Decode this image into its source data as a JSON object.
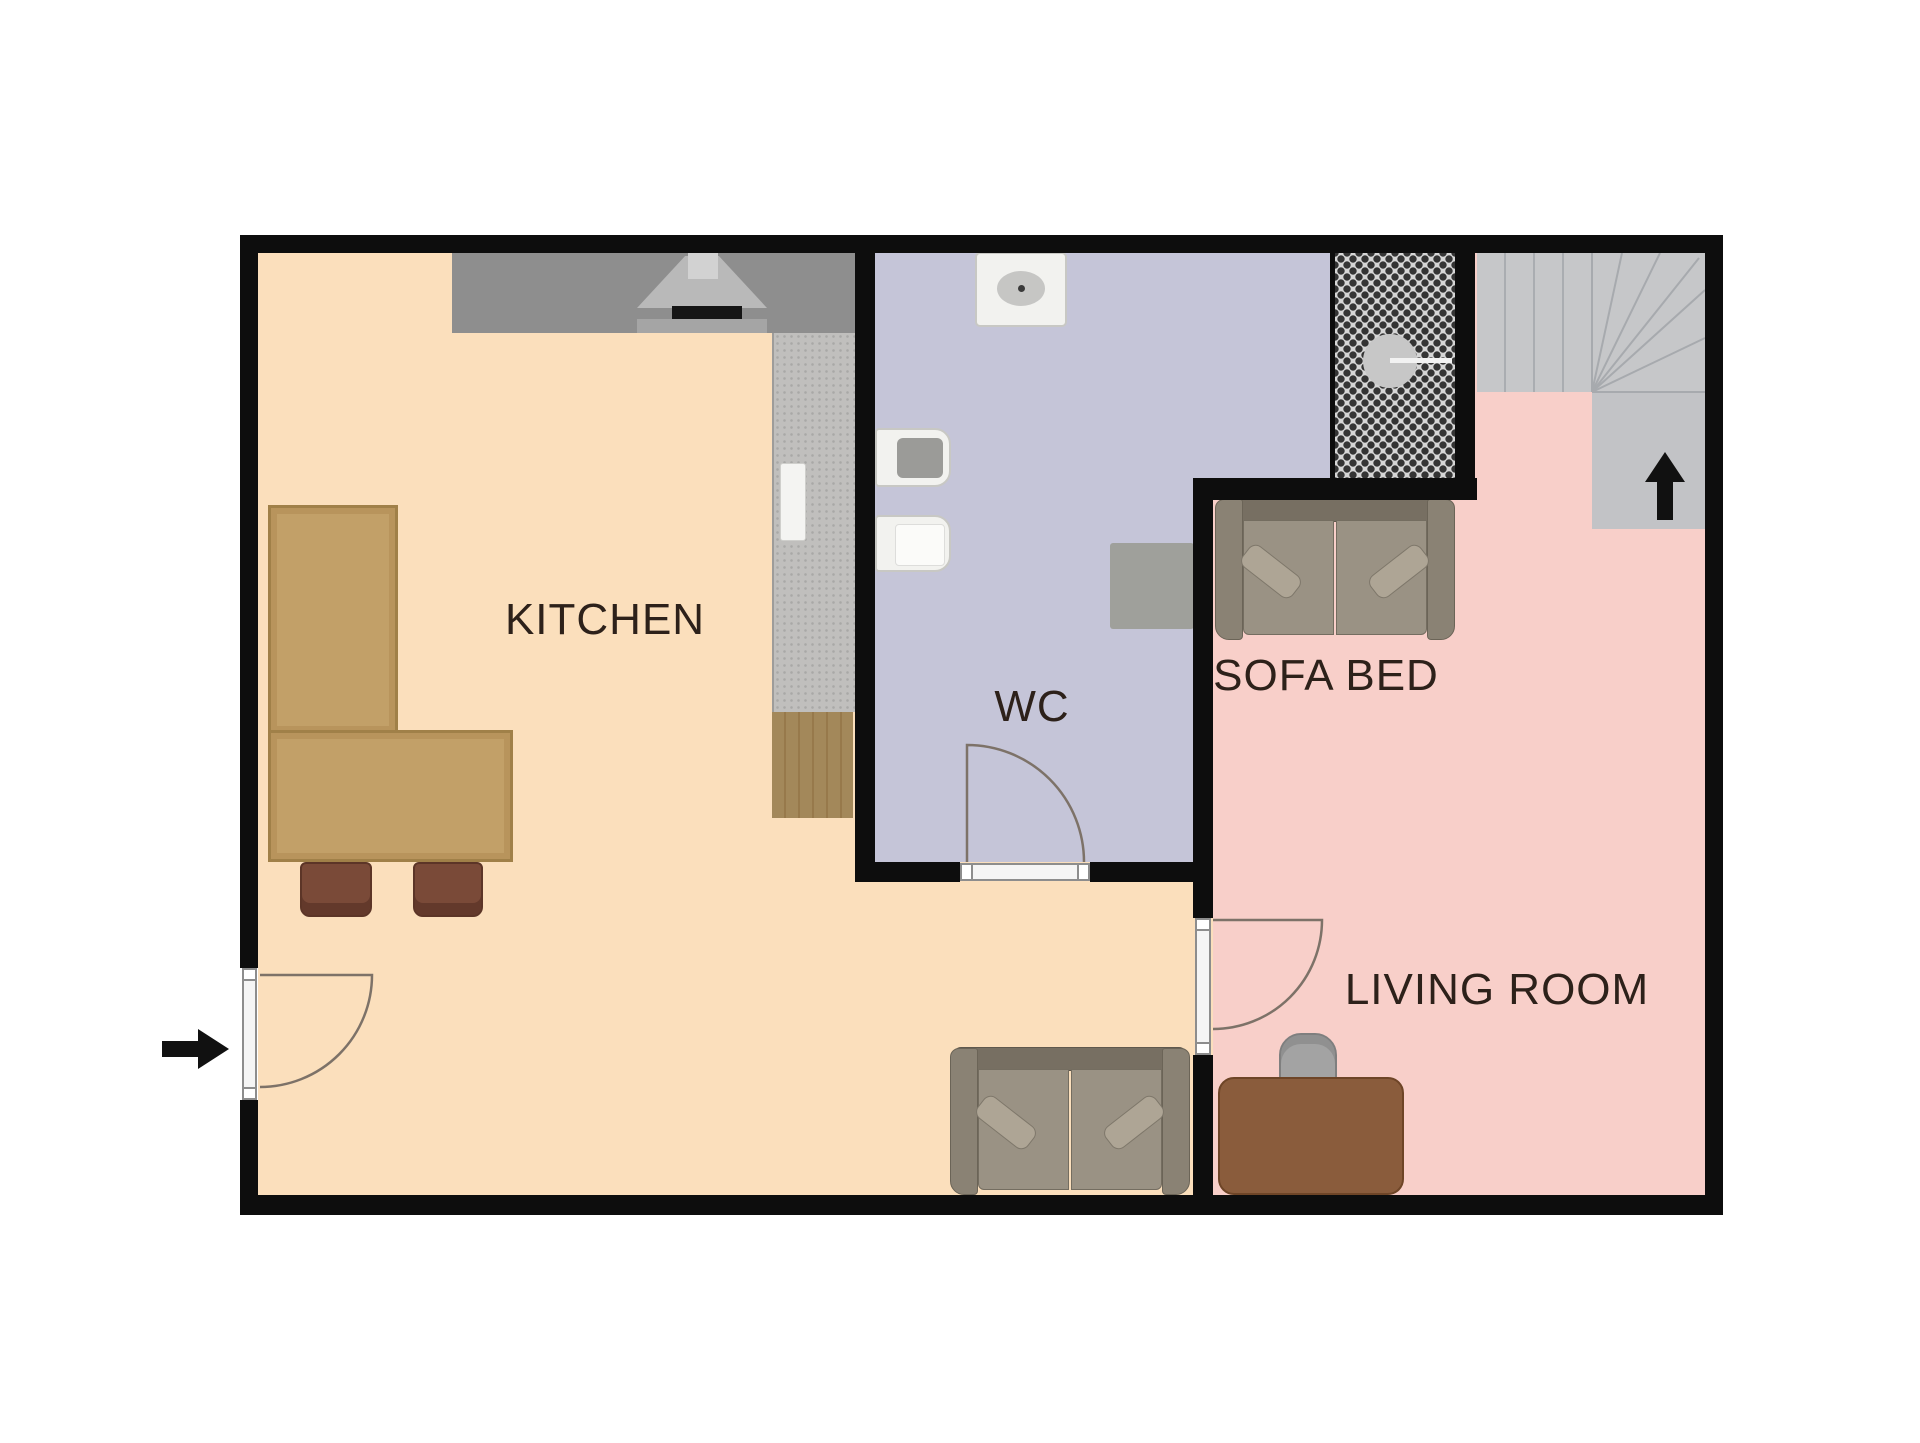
{
  "plan": {
    "type": "apartment floor plan",
    "rooms": [
      {
        "key": "kitchen",
        "label": "KITCHEN"
      },
      {
        "key": "wc",
        "label": "WC"
      },
      {
        "key": "sofa_bed",
        "label": "SOFA BED"
      },
      {
        "key": "living_room",
        "label": "LIVING ROOM"
      }
    ],
    "symbols": {
      "entrance_arrow": "entrance direction arrow (points right, into kitchen)",
      "stairs_arrow": "stairs direction arrow (up)"
    },
    "colors": {
      "wall": "#0d0d0d",
      "kitchen_floor": "#fbdfbc",
      "wc_floor": "#c5c5d8",
      "living_floor": "#f8cfc9",
      "stairs": "#c6c7c9",
      "counter": "#8e8e8e",
      "wood_table": "#c2a068",
      "label_text": "#2d211a"
    }
  }
}
